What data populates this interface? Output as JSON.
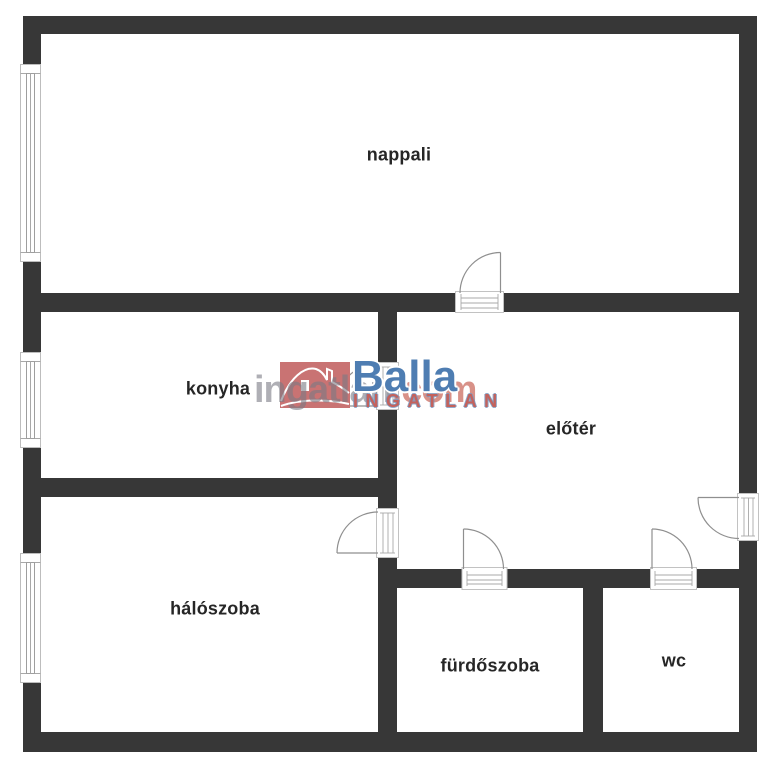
{
  "plan": {
    "rooms": [
      {
        "id": "nappali",
        "label": "nappali"
      },
      {
        "id": "konyha",
        "label": "konyha"
      },
      {
        "id": "eloter",
        "label": "előtér"
      },
      {
        "id": "haloszoba",
        "label": "hálószoba"
      },
      {
        "id": "furdoszoba",
        "label": "fürdőszoba"
      },
      {
        "id": "wc",
        "label": "wc"
      }
    ]
  },
  "watermark": {
    "site_name": "ingatlan",
    "site_tld": ".com",
    "brand": "Balla",
    "brand_word": "INGATLAN"
  },
  "colors": {
    "wall": "#373737",
    "label_text": "#262626",
    "brand_blue": "#4e7db2",
    "logo_box_red": "#c97373",
    "brand_word_red": "#c4625c",
    "watermark_gray": "#7a7a84",
    "watermark_salmon": "#ce766a",
    "symbol_line_gray": "#a8a8a8"
  }
}
